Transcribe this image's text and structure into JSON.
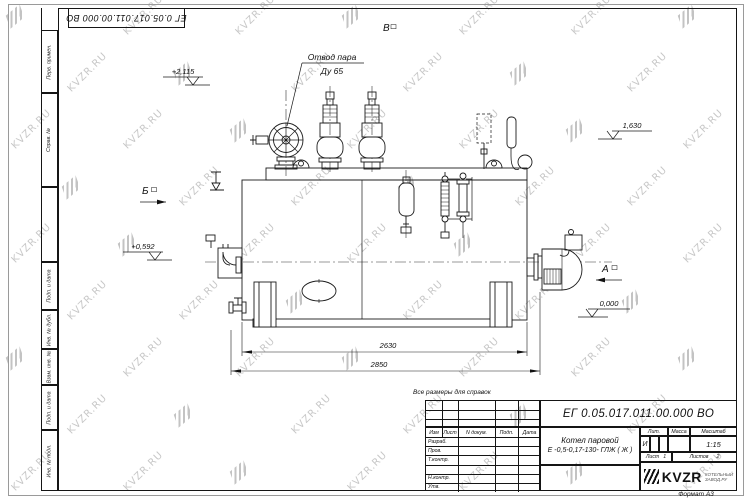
{
  "watermark": {
    "text": "KVZR.RU"
  },
  "corner": {
    "doc_number": "ЕГ 0.05.017.011.00.000  ВО"
  },
  "left_strip": {
    "labels": [
      "Перв. примен.",
      "Справ. №",
      "Подп. и дата",
      "Инв. № дубл.",
      "Взам. инв. №",
      "Подп. и дата",
      "Инв. № подл."
    ]
  },
  "drawing": {
    "note": "Все размеры для справок",
    "callout": {
      "line1": "Отвод пара",
      "line2": "Ду 65"
    },
    "views": {
      "a": "А",
      "b": "Б",
      "v": "В"
    },
    "elev": {
      "e1": "+2,115",
      "e2": "1,630",
      "e3": "+0,592",
      "e4": "0,000"
    },
    "dims": {
      "d1": "2630",
      "d2": "2850"
    }
  },
  "title": {
    "doc_number": "ЕГ 0.05.017.011.00.000  ВО",
    "product": {
      "line1": "Котел паровой",
      "line2": "Е -0,5-0,17-130- ГЛЖ ( Ж )"
    },
    "cols": {
      "izm": "Изм",
      "list": "Лист",
      "doc": "N докум.",
      "podp": "Подп.",
      "data": "Дата"
    },
    "rows": [
      "Разраб.",
      "Пров.",
      "Т.контр.",
      "",
      "Н.контр.",
      "Утв."
    ],
    "lit_h": "Лит.",
    "mass_h": "Масса",
    "scale_h": "Масштаб",
    "lit_v": "И",
    "scale_v": "1:15",
    "sheet_l": "Лист",
    "sheet_v": "1",
    "sheets_l": "Листов",
    "sheets_v": "2",
    "logo": {
      "text": "KVZR",
      "sub1": "КОТЕЛЬНЫЙ",
      "sub2": "ЗАВОД.РУ"
    },
    "format": "Формат А3"
  }
}
